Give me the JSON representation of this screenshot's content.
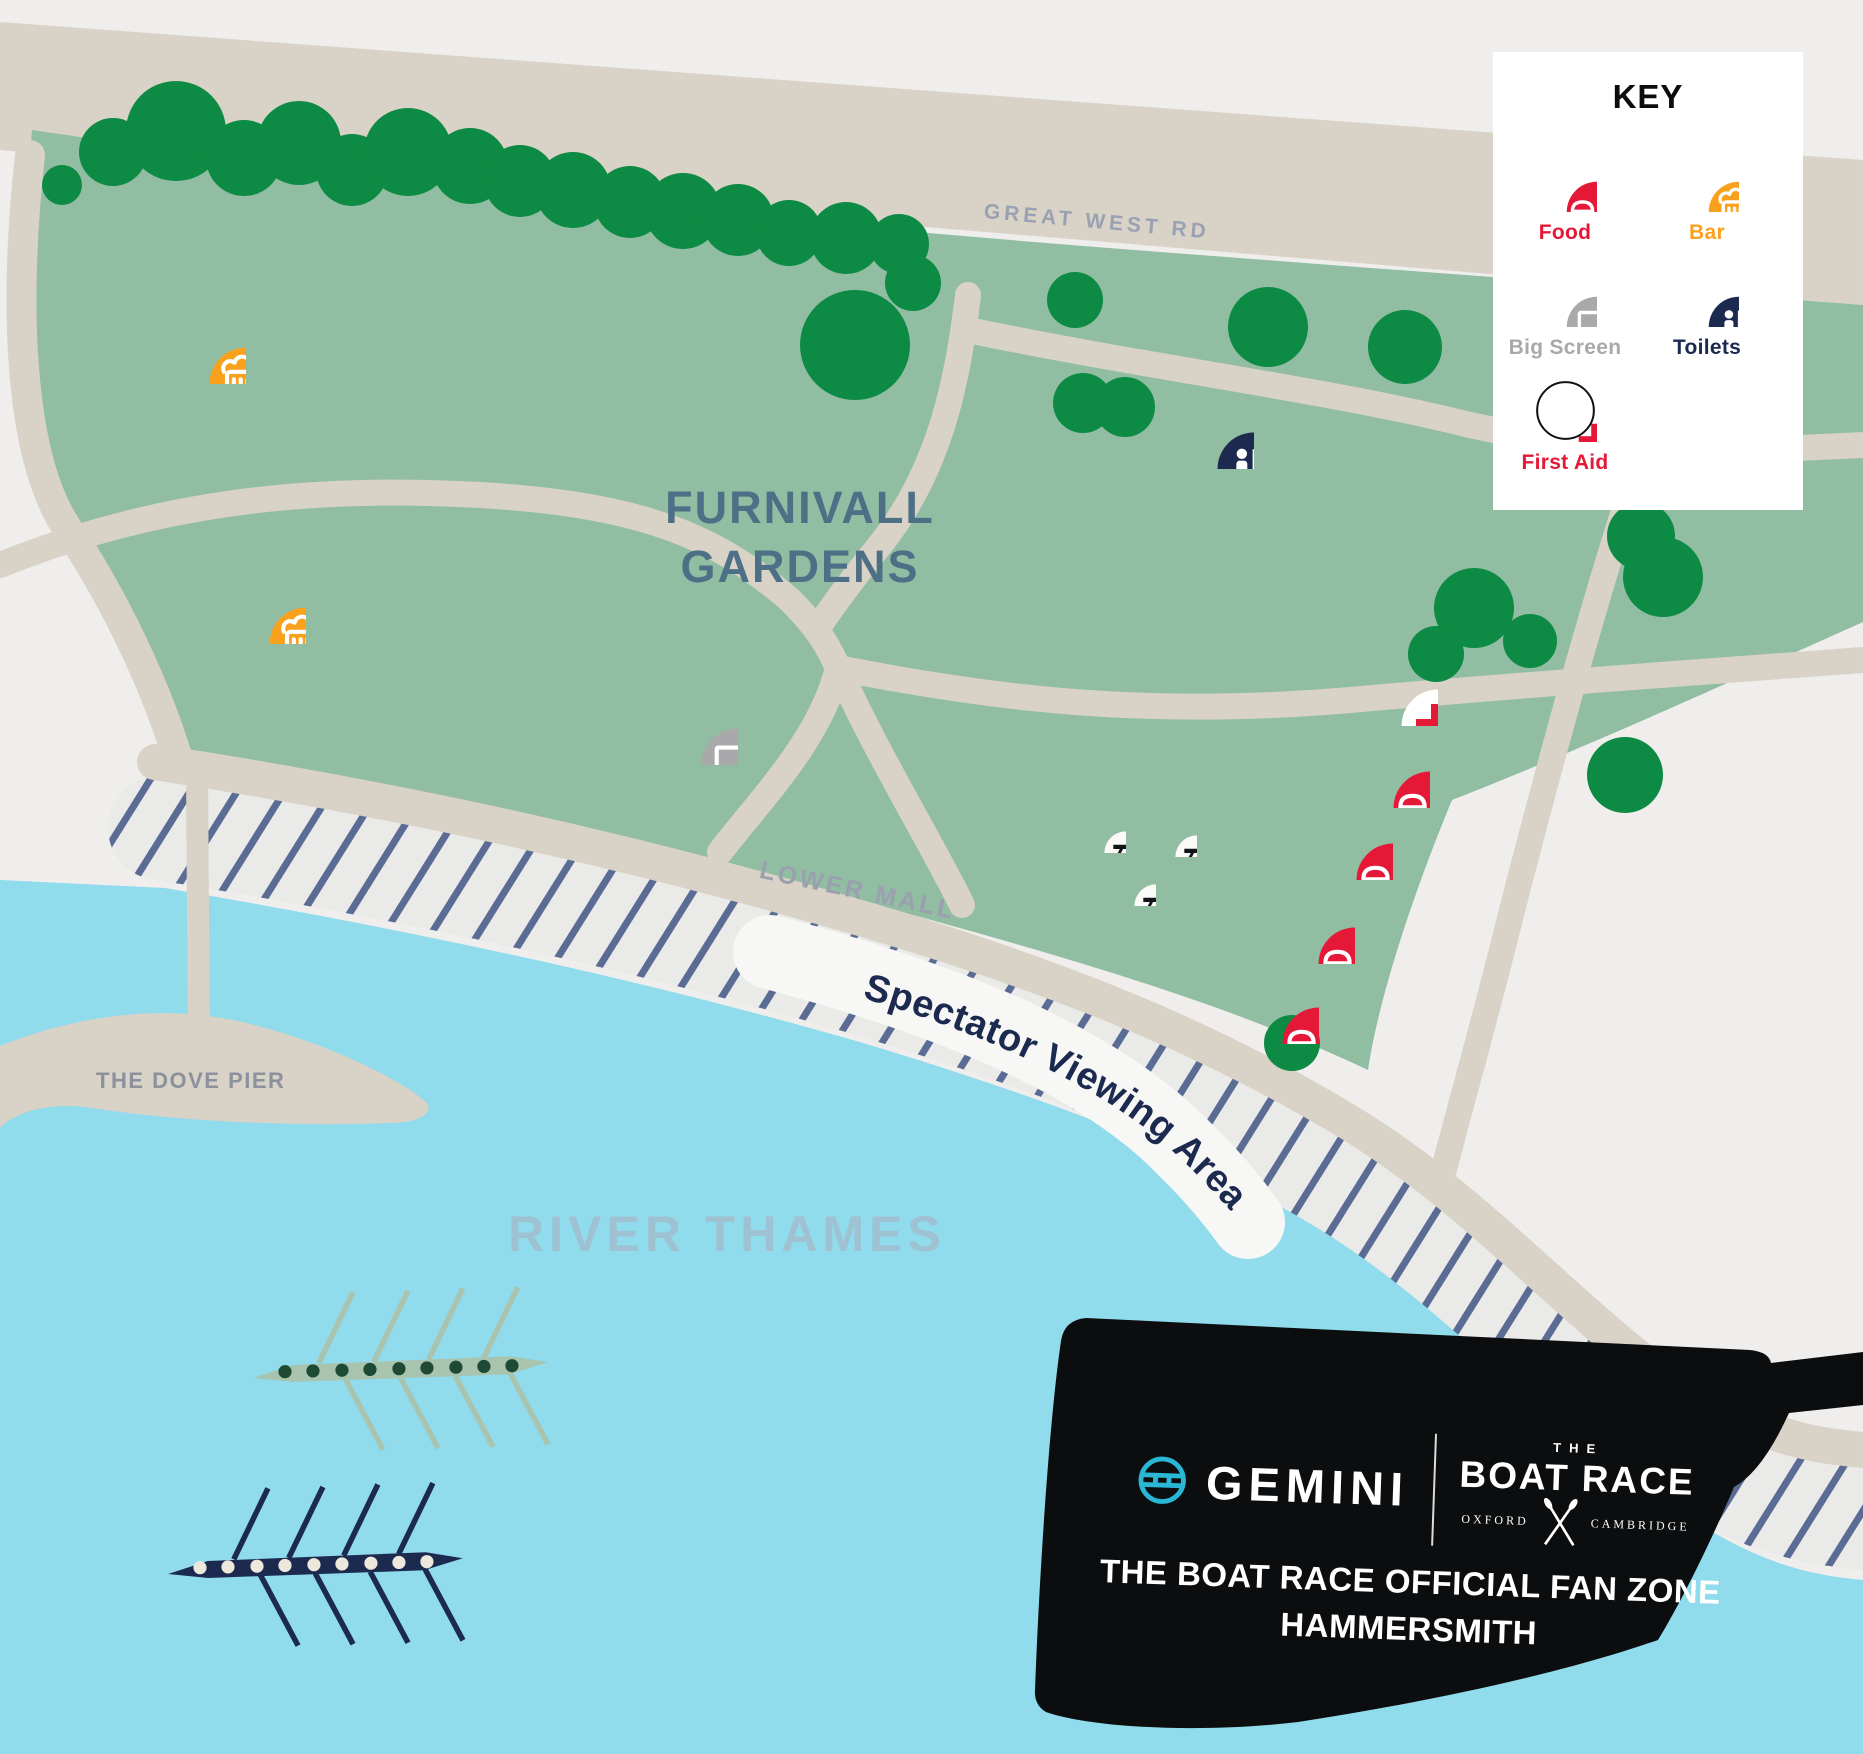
{
  "map": {
    "labels": {
      "great_west_rd": "GREAT WEST RD",
      "furnivall_line1": "FURNIVALL",
      "furnivall_line2": "GARDENS",
      "lower_mall": "LOWER MALL",
      "spectator": "Spectator Viewing Area",
      "dove_pier": "THE DOVE PIER",
      "river": "RIVER THAMES"
    },
    "markers": [
      {
        "type": "bar",
        "x": 208,
        "y": 346
      },
      {
        "type": "bar",
        "x": 268,
        "y": 606
      },
      {
        "type": "big-screen",
        "x": 700,
        "y": 727
      },
      {
        "type": "toilets",
        "x": 1216,
        "y": 431
      },
      {
        "type": "first-aid",
        "x": 1400,
        "y": 688
      },
      {
        "type": "food",
        "x": 1392,
        "y": 770
      },
      {
        "type": "food",
        "x": 1355,
        "y": 842
      },
      {
        "type": "food",
        "x": 1317,
        "y": 926
      },
      {
        "type": "food",
        "x": 1281,
        "y": 1006
      },
      {
        "type": "picnic",
        "x": 1102,
        "y": 829
      },
      {
        "type": "picnic",
        "x": 1173,
        "y": 833
      },
      {
        "type": "picnic",
        "x": 1132,
        "y": 882
      }
    ]
  },
  "key": {
    "title": "KEY",
    "items": [
      {
        "id": "food",
        "label": "Food",
        "color": "#e51937"
      },
      {
        "id": "bar",
        "label": "Bar",
        "color": "#f9a11d"
      },
      {
        "id": "big-screen",
        "label": "Big Screen",
        "color": "#a9a9ab"
      },
      {
        "id": "toilets",
        "label": "Toilets",
        "color": "#1b2a4e"
      },
      {
        "id": "first-aid",
        "label": "First Aid",
        "color": "#e51937"
      }
    ]
  },
  "banner": {
    "brand": "GEMINI",
    "race_the": "THE",
    "race_name": "BOAT RACE",
    "race_left": "OXFORD",
    "race_right": "CAMBRIDGE",
    "line1": "THE BOAT RACE OFFICIAL FAN ZONE",
    "line2": "HAMMERSMITH"
  },
  "colors": {
    "background": "#efeeec",
    "park": "#91bda3",
    "tree": "#0d8a43",
    "river": "#90dbec",
    "road": "#d9d2c6",
    "navy": "#1b2a4e",
    "red": "#e51937",
    "orange": "#f9a11d",
    "gray": "#a9a9ab",
    "hatch_line": "#5a6b94",
    "steel_blue": "#4e7086"
  }
}
